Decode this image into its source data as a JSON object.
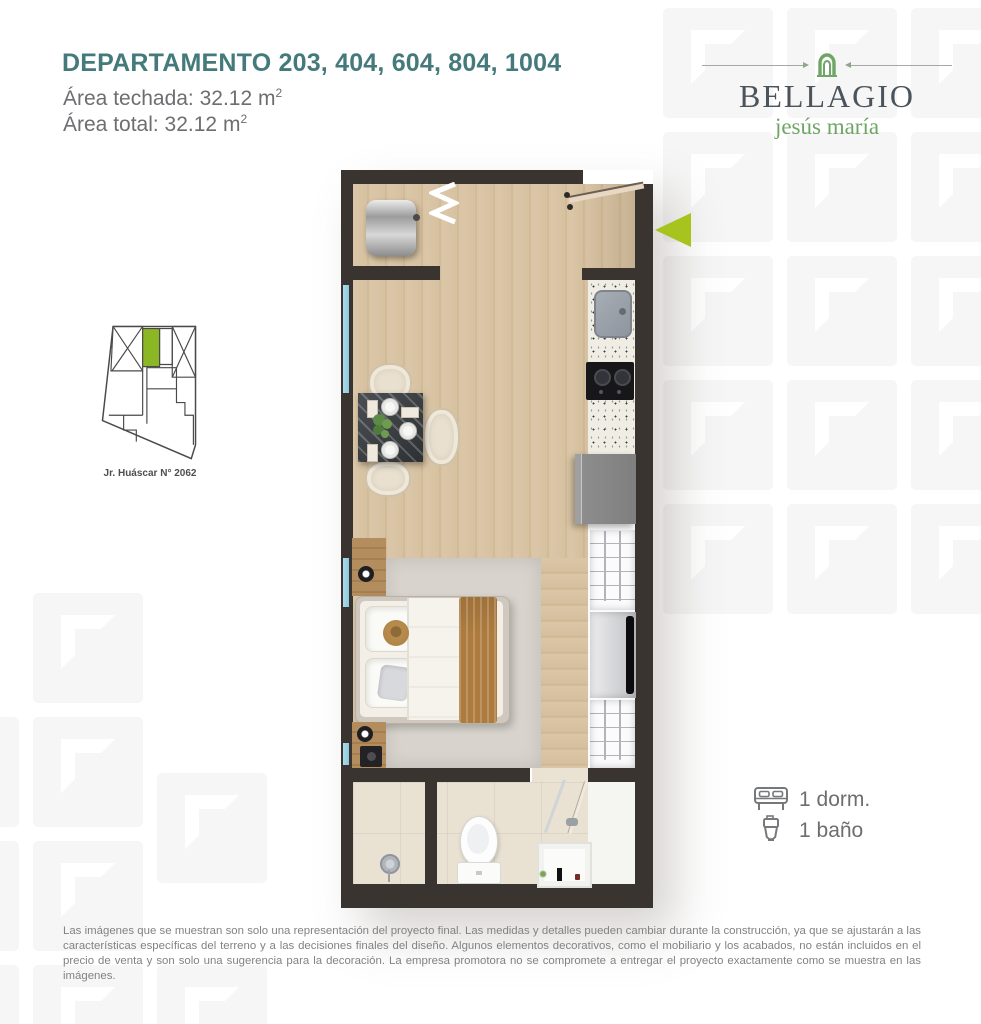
{
  "page": {
    "title": "DEPARTAMENTO 203, 404, 604, 804, 1004",
    "area_techada": "Área techada: 32.12 m",
    "area_techada_sup": "2",
    "area_total": "Área total: 32.12 m",
    "area_total_sup": "2",
    "disclaimer": "Las imágenes que se muestran son solo una representación del proyecto final. Las medidas y detalles pueden cambiar durante la construcción, ya que se ajustarán a las características específicas del terreno y a las decisiones finales del diseño. Algunos elementos decorativos, como el mobiliario y los acabados, no están incluidos en el precio de venta y son solo una sugerencia para la decoración. La empresa promotora no se compromete a entregar el proyecto exactamente como se muestra en las imágenes."
  },
  "logo": {
    "name": "BELLAGIO",
    "tagline": "jesús maría",
    "icon": "arch-icon"
  },
  "sitemap": {
    "caption": "Jr. Huáscar N° 2062",
    "highlight_color": "#8cb724"
  },
  "features": [
    {
      "icon": "bed-icon",
      "label": "1 dorm."
    },
    {
      "icon": "toilet-icon",
      "label": "1 baño"
    }
  ],
  "plan": {
    "entry_marker_icon": "arrow-left-icon",
    "rooms": [
      "cocina",
      "sala-comedor",
      "dormitorio",
      "baño",
      "lavandería"
    ]
  },
  "colors": {
    "title_teal": "#447a7b",
    "text_gray": "#6d6e71",
    "accent_green": "#a6c41d",
    "brand_green": "#6fa565",
    "logo_gray": "#4c545b",
    "wall_dark": "#3a3430"
  }
}
